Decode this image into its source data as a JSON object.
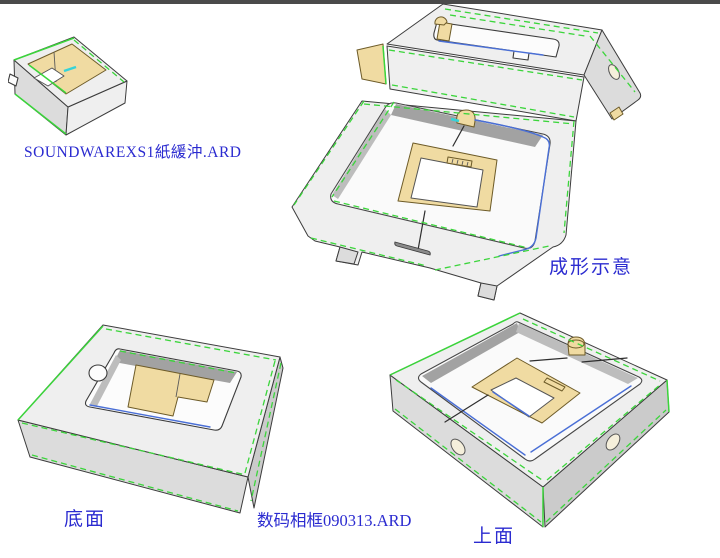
{
  "document": {
    "type": "packaging-cad-3d-views",
    "view_count": 4
  },
  "labels": {
    "design1_filename": "SOUNDWAREXS1紙緩沖.ARD",
    "formed_view": "成形示意",
    "bottom_face_view": "底面",
    "design2_filename": "数码相框090313.ARD",
    "top_face_view": "上面"
  },
  "views": [
    {
      "name": "thumbnail-3d-render",
      "caption": "SOUNDWAREXS1紙緩沖.ARD"
    },
    {
      "name": "formed-assembly-render",
      "caption": "成形示意"
    },
    {
      "name": "bottom-face-render",
      "caption": "底面"
    },
    {
      "name": "top-face-render",
      "caption": "上面"
    }
  ],
  "colors": {
    "background": "#ffffff",
    "top_bar": "#4a4a4a",
    "label_text": "#2b2bd0",
    "fold_green": "#3bd53b",
    "crease_blue": "#4a6fd6",
    "highlight_cyan": "#35d3d8",
    "kraft_tan": "#f0dba2",
    "board_face": "#efefef",
    "board_shade": "#dcdcdc",
    "board_deep": "#cbcbcb",
    "wall_gray": "#a2a2a2",
    "cut_outline": "#3c3c3c"
  }
}
